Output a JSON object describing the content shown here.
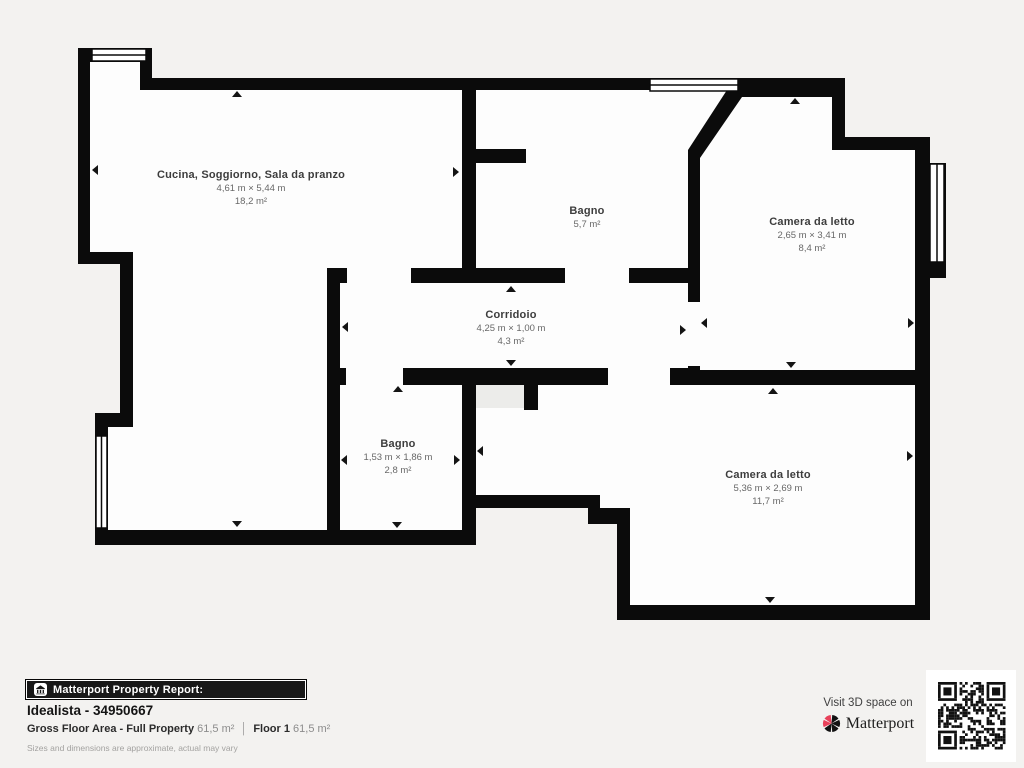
{
  "plan": {
    "rooms": [
      {
        "name": "Cucina, Soggiorno, Sala da pranzo",
        "dimensions": "4,61 m × 5,44 m",
        "area": "18,2 m²"
      },
      {
        "name": "Bagno",
        "dimensions": "",
        "area": "5,7 m²"
      },
      {
        "name": "Camera da letto",
        "dimensions": "2,65 m × 3,41 m",
        "area": "8,4 m²"
      },
      {
        "name": "Corridoio",
        "dimensions": "4,25 m × 1,00 m",
        "area": "4,3 m²"
      },
      {
        "name": "Bagno",
        "dimensions": "1,53 m × 1,86 m",
        "area": "2,8 m²"
      },
      {
        "name": "Camera da letto",
        "dimensions": "5,36 m × 2,69 m",
        "area": "11,7 m²"
      }
    ]
  },
  "footer": {
    "report_bar_label": "Matterport Property Report:",
    "property_title": "Idealista - 34950667",
    "gfa_label": "Gross Floor Area - Full Property",
    "gfa_value": "61,5 m²",
    "divider": "│",
    "floor_label": "Floor 1",
    "floor_value": "61,5 m²",
    "disclaimer": "Sizes and dimensions are approximate, actual may vary"
  },
  "branding": {
    "visit_text": "Visit 3D space on",
    "brand_name": "Matterport"
  },
  "icons": {
    "house_icon": "matterport-house-icon",
    "logo_icon": "matterport-pinwheel-icon",
    "qr": "qr-code"
  },
  "colors": {
    "background": "#f3f2f0",
    "wall": "#0b0b0b",
    "room_fill": "#fdfdfd",
    "accent_red": "#e8415a",
    "label_title": "#3d3d3d",
    "label_dims": "#686868"
  }
}
